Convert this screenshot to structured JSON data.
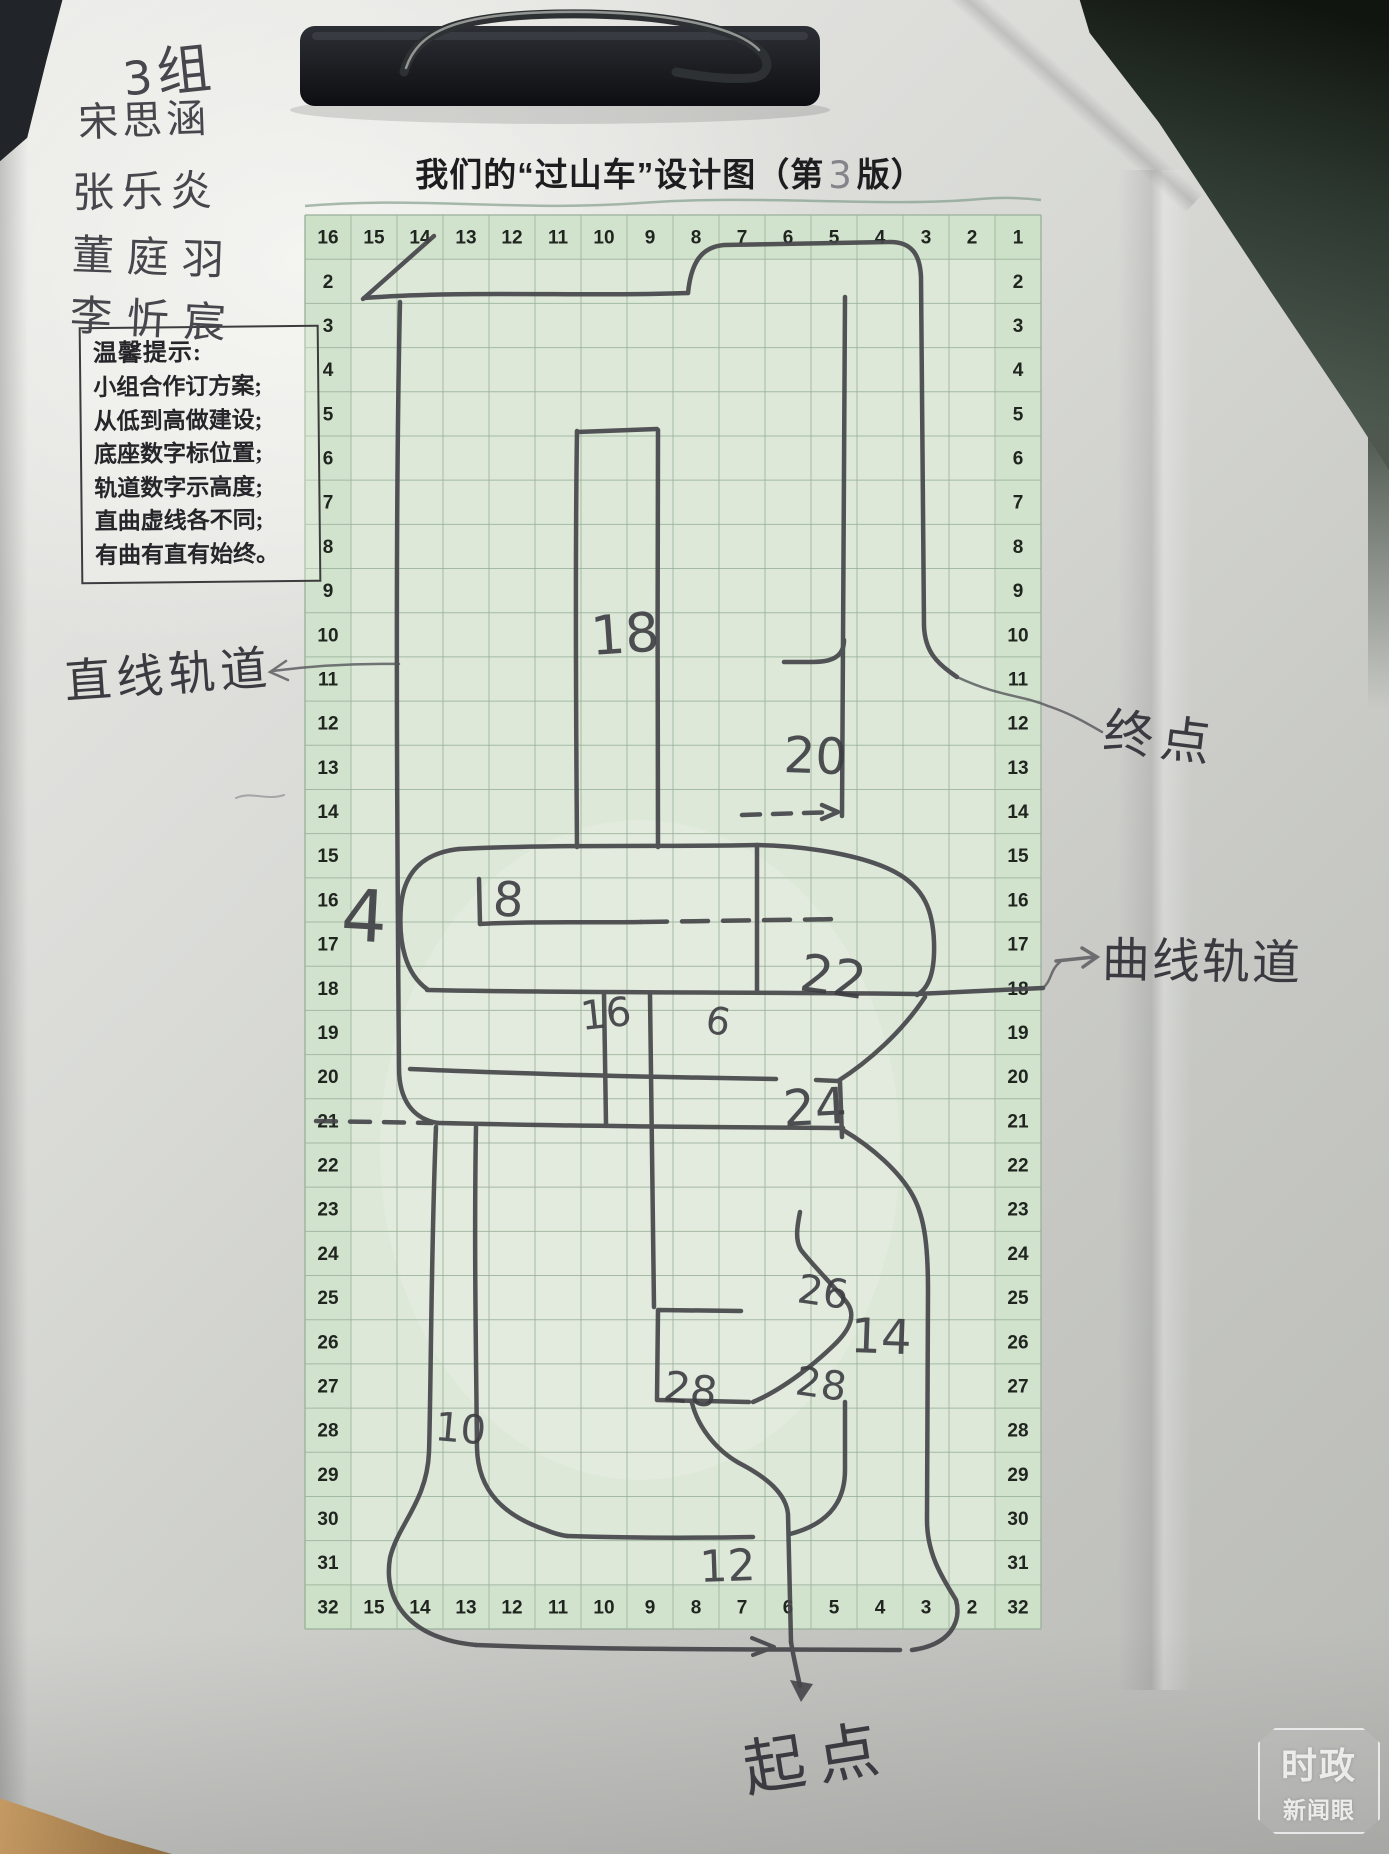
{
  "title": {
    "prefix": "我们的“过山车”设计图（第",
    "version": "3",
    "suffix": "版）"
  },
  "group": {
    "number_label": "3",
    "suffix": "组",
    "members": [
      "宋思涵",
      "张乐炎",
      "董庭羽",
      "李忻宸"
    ]
  },
  "tips": {
    "heading": "温馨提示:",
    "lines": [
      "小组合作订方案;",
      "从低到高做建设;",
      "底座数字标位置;",
      "轨道数字示高度;",
      "直曲虚线各不同;",
      "有曲有直有始终。"
    ]
  },
  "grid": {
    "cols": 16,
    "rows": 32,
    "top_row": [
      "16",
      "15",
      "14",
      "13",
      "12",
      "11",
      "10",
      "9",
      "8",
      "7",
      "6",
      "5",
      "4",
      "3",
      "2",
      "1"
    ],
    "bottom_row": [
      "32",
      "15",
      "14",
      "13",
      "12",
      "11",
      "10",
      "9",
      "8",
      "7",
      "6",
      "5",
      "4",
      "3",
      "2",
      "32"
    ],
    "left_col": [
      "2",
      "3",
      "4",
      "5",
      "6",
      "7",
      "8",
      "9",
      "10",
      "11",
      "12",
      "13",
      "14",
      "15",
      "16",
      "17",
      "18",
      "19",
      "20",
      "21",
      "22",
      "23",
      "24",
      "25",
      "26",
      "27",
      "28",
      "29",
      "30",
      "31"
    ],
    "right_col": [
      "2",
      "3",
      "4",
      "5",
      "6",
      "7",
      "8",
      "9",
      "10",
      "11",
      "12",
      "13",
      "14",
      "15",
      "16",
      "17",
      "18",
      "19",
      "20",
      "21",
      "22",
      "23",
      "24",
      "25",
      "26",
      "27",
      "28",
      "29",
      "30",
      "31"
    ]
  },
  "track_numbers": [
    {
      "value": "18"
    },
    {
      "value": "20"
    },
    {
      "value": "4"
    },
    {
      "value": "8"
    },
    {
      "value": "22"
    },
    {
      "value": "16"
    },
    {
      "value": "6"
    },
    {
      "value": "24"
    },
    {
      "value": "26"
    },
    {
      "value": "14"
    },
    {
      "value": "28"
    },
    {
      "value": "28"
    },
    {
      "value": "10"
    },
    {
      "value": "12"
    }
  ],
  "annotations": {
    "straight_track": "直线轨道",
    "end_point": "终点",
    "curved_track": "曲线轨道",
    "start_point": "起点"
  },
  "watermark": {
    "line1": "时政",
    "line2": "新闻眼"
  },
  "colors": {
    "grid_paper": "#dde8d8",
    "pencil": "#45454a",
    "watermark_text": "#fcfcfa"
  }
}
